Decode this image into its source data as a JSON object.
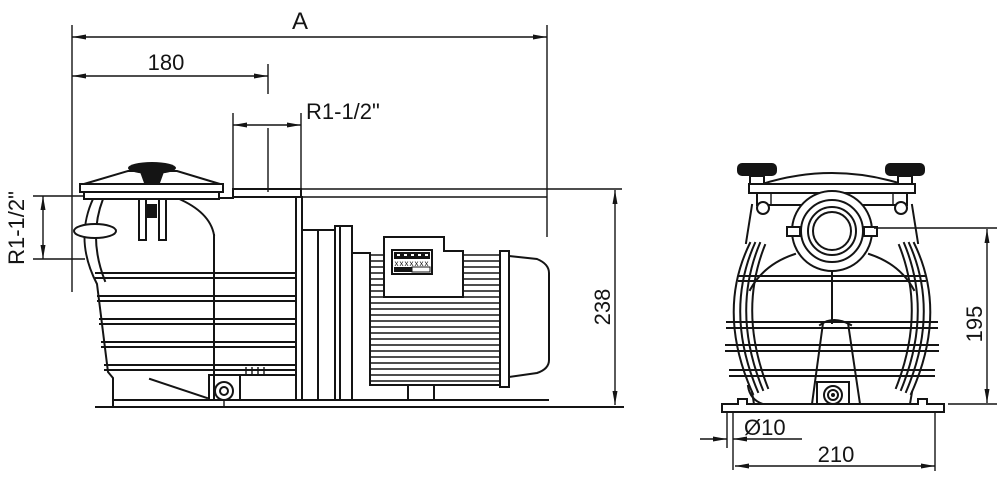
{
  "dimensions": {
    "overall_length": "A",
    "inlet_to_outlet_center": "180",
    "outlet_port": "R1-1/2\"",
    "inlet_port": "R1-1/2\"",
    "overall_height": "238",
    "port_center_height": "195",
    "mount_hole_diameter": "Ø10",
    "base_length": "210"
  },
  "nameplate": {
    "row": "xxxxxxx"
  },
  "colors": {
    "ink": "#141414",
    "background": "#ffffff"
  }
}
